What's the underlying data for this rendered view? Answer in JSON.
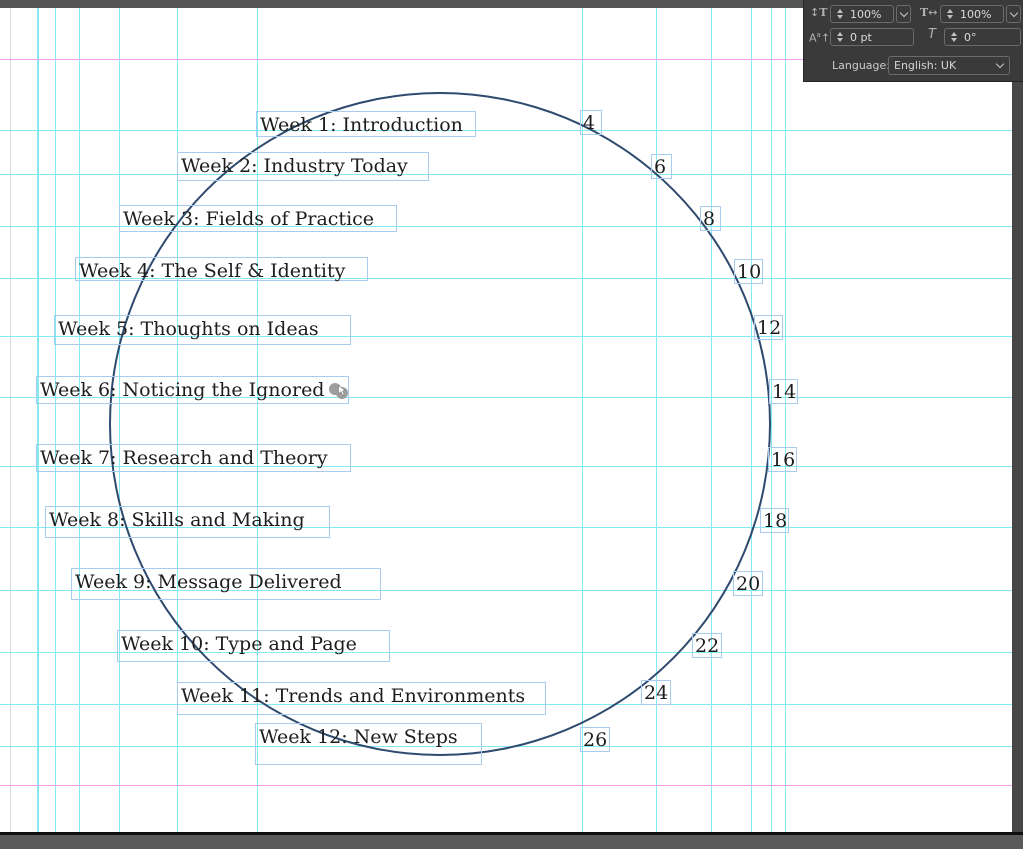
{
  "panel": {
    "v_scale": "100%",
    "h_scale": "100%",
    "baseline_shift": "0 pt",
    "skew": "0°",
    "language_label": "Language:",
    "language_value": "English: UK"
  },
  "document": {
    "weeks": [
      {
        "label": "Week 1: Introduction",
        "x": 256,
        "y": 111,
        "w": 220,
        "h": 26
      },
      {
        "label": "Week 2: Industry Today",
        "x": 177,
        "y": 152,
        "w": 252,
        "h": 29
      },
      {
        "label": "Week 3: Fields of Practice",
        "x": 119,
        "y": 205,
        "w": 278,
        "h": 27
      },
      {
        "label": "Week 4: The Self & Identity",
        "x": 75,
        "y": 257,
        "w": 293,
        "h": 24
      },
      {
        "label": "Week 5: Thoughts on Ideas",
        "x": 54,
        "y": 315,
        "w": 297,
        "h": 30
      },
      {
        "label": "Week 6: Noticing the Ignored",
        "x": 36,
        "y": 376,
        "w": 313,
        "h": 28
      },
      {
        "label": "Week 7: Research and Theory",
        "x": 36,
        "y": 444,
        "w": 315,
        "h": 28
      },
      {
        "label": "Week 8: Skills and Making",
        "x": 45,
        "y": 506,
        "w": 285,
        "h": 32
      },
      {
        "label": "Week 9: Message Delivered",
        "x": 71,
        "y": 568,
        "w": 310,
        "h": 32
      },
      {
        "label": "Week 10: Type and Page",
        "x": 117,
        "y": 630,
        "w": 273,
        "h": 32
      },
      {
        "label": "Week 11: Trends and Environments",
        "x": 177,
        "y": 682,
        "w": 369,
        "h": 33
      },
      {
        "label": "Week 12: New Steps",
        "x": 255,
        "y": 723,
        "w": 227,
        "h": 42
      }
    ],
    "page_numbers": [
      {
        "label": "4",
        "x": 580,
        "y": 110,
        "w": 22,
        "h": 25
      },
      {
        "label": "6",
        "x": 651,
        "y": 154,
        "w": 21,
        "h": 25
      },
      {
        "label": "8",
        "x": 700,
        "y": 206,
        "w": 21,
        "h": 25
      },
      {
        "label": "10",
        "x": 734,
        "y": 259,
        "w": 29,
        "h": 25
      },
      {
        "label": "12",
        "x": 754,
        "y": 315,
        "w": 29,
        "h": 25
      },
      {
        "label": "14",
        "x": 769,
        "y": 379,
        "w": 29,
        "h": 25
      },
      {
        "label": "16",
        "x": 768,
        "y": 447,
        "w": 29,
        "h": 25
      },
      {
        "label": "18",
        "x": 760,
        "y": 508,
        "w": 29,
        "h": 25
      },
      {
        "label": "20",
        "x": 733,
        "y": 571,
        "w": 30,
        "h": 25
      },
      {
        "label": "22",
        "x": 692,
        "y": 633,
        "w": 30,
        "h": 25
      },
      {
        "label": "24",
        "x": 641,
        "y": 680,
        "w": 30,
        "h": 25
      },
      {
        "label": "26",
        "x": 580,
        "y": 727,
        "w": 30,
        "h": 25
      }
    ],
    "circle": {
      "cx": 441,
      "cy": 425,
      "rx": 331,
      "ry": 332
    },
    "guides": {
      "vertical": [
        {
          "x": 37,
          "w": 2
        },
        {
          "x": 55
        },
        {
          "x": 79
        },
        {
          "x": 119
        },
        {
          "x": 177
        },
        {
          "x": 257
        },
        {
          "x": 582
        },
        {
          "x": 656
        },
        {
          "x": 711
        },
        {
          "x": 751
        },
        {
          "x": 771
        },
        {
          "x": 785
        }
      ],
      "horizontal": [
        130,
        174,
        226,
        278,
        336,
        397,
        466,
        527,
        590,
        652,
        704,
        746
      ],
      "margins": [
        59,
        785
      ]
    }
  },
  "colors": {
    "guide_cyan": "#84ebf2",
    "guide_margin": "#ff9bf0",
    "frame_border": "#a9cbee",
    "circle_stroke": "#2e4a6e",
    "text": "#1d1d1d"
  }
}
